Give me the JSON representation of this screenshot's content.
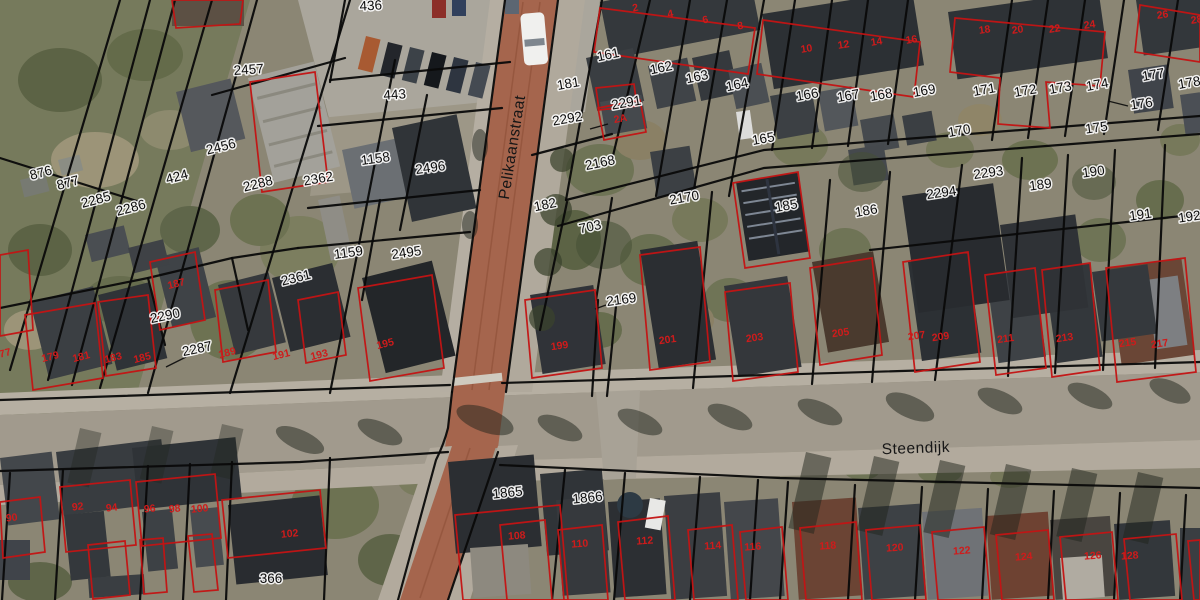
{
  "map": {
    "type": "cadastral-aerial",
    "street_labels": [
      {
        "text": "Pelikaanstraat",
        "x": 517,
        "y": 148,
        "rot": -81
      },
      {
        "text": "Steendijk",
        "x": 916,
        "y": 453,
        "rot": -2
      }
    ],
    "parcel_labels": [
      {
        "text": "436",
        "x": 371,
        "y": 10,
        "rot": -3
      },
      {
        "text": "443",
        "x": 395,
        "y": 99,
        "rot": -4
      },
      {
        "text": "2457",
        "x": 249,
        "y": 74,
        "rot": -4
      },
      {
        "text": "2456",
        "x": 222,
        "y": 151,
        "rot": -14
      },
      {
        "text": "2288",
        "x": 259,
        "y": 188,
        "rot": -14
      },
      {
        "text": "876",
        "x": 42,
        "y": 177,
        "rot": -15
      },
      {
        "text": "877",
        "x": 69,
        "y": 187,
        "rot": -15
      },
      {
        "text": "2285",
        "x": 97,
        "y": 204,
        "rot": -15
      },
      {
        "text": "2286",
        "x": 132,
        "y": 212,
        "rot": -15
      },
      {
        "text": "424",
        "x": 178,
        "y": 181,
        "rot": -15
      },
      {
        "text": "2362",
        "x": 319,
        "y": 183,
        "rot": -10
      },
      {
        "text": "1158",
        "x": 376,
        "y": 163,
        "rot": -8
      },
      {
        "text": "2496",
        "x": 431,
        "y": 172,
        "rot": -8
      },
      {
        "text": "1159",
        "x": 349,
        "y": 257,
        "rot": -8
      },
      {
        "text": "2495",
        "x": 407,
        "y": 257,
        "rot": -8
      },
      {
        "text": "2361",
        "x": 297,
        "y": 282,
        "rot": -14
      },
      {
        "text": "2290",
        "x": 166,
        "y": 320,
        "rot": -12
      },
      {
        "text": "2287",
        "x": 198,
        "y": 353,
        "rot": -12
      },
      {
        "text": "181",
        "x": 569,
        "y": 88,
        "rot": -10
      },
      {
        "text": "2292",
        "x": 568,
        "y": 123,
        "rot": -10
      },
      {
        "text": "2291",
        "x": 627,
        "y": 107,
        "rot": -10
      },
      {
        "text": "161",
        "x": 609,
        "y": 59,
        "rot": -12
      },
      {
        "text": "162",
        "x": 662,
        "y": 72,
        "rot": -12
      },
      {
        "text": "163",
        "x": 698,
        "y": 81,
        "rot": -12
      },
      {
        "text": "164",
        "x": 738,
        "y": 89,
        "rot": -12
      },
      {
        "text": "165",
        "x": 764,
        "y": 143,
        "rot": -10
      },
      {
        "text": "166",
        "x": 808,
        "y": 99,
        "rot": -10
      },
      {
        "text": "167",
        "x": 849,
        "y": 100,
        "rot": -10
      },
      {
        "text": "168",
        "x": 882,
        "y": 99,
        "rot": -10
      },
      {
        "text": "169",
        "x": 925,
        "y": 95,
        "rot": -10
      },
      {
        "text": "170",
        "x": 960,
        "y": 135,
        "rot": -10
      },
      {
        "text": "171",
        "x": 985,
        "y": 94,
        "rot": -10
      },
      {
        "text": "172",
        "x": 1026,
        "y": 95,
        "rot": -10
      },
      {
        "text": "173",
        "x": 1061,
        "y": 92,
        "rot": -10
      },
      {
        "text": "174",
        "x": 1098,
        "y": 89,
        "rot": -10
      },
      {
        "text": "175",
        "x": 1097,
        "y": 132,
        "rot": -8
      },
      {
        "text": "176",
        "x": 1142,
        "y": 108,
        "rot": -8
      },
      {
        "text": "177",
        "x": 1154,
        "y": 79,
        "rot": -10
      },
      {
        "text": "178",
        "x": 1190,
        "y": 87,
        "rot": -10
      },
      {
        "text": "2168",
        "x": 601,
        "y": 167,
        "rot": -12
      },
      {
        "text": "182",
        "x": 546,
        "y": 209,
        "rot": -12
      },
      {
        "text": "703",
        "x": 591,
        "y": 231,
        "rot": -12
      },
      {
        "text": "2170",
        "x": 685,
        "y": 202,
        "rot": -10
      },
      {
        "text": "2169",
        "x": 622,
        "y": 304,
        "rot": -8
      },
      {
        "text": "185",
        "x": 787,
        "y": 210,
        "rot": -10
      },
      {
        "text": "186",
        "x": 867,
        "y": 215,
        "rot": -10
      },
      {
        "text": "2293",
        "x": 989,
        "y": 177,
        "rot": -8
      },
      {
        "text": "2294",
        "x": 942,
        "y": 197,
        "rot": -8
      },
      {
        "text": "189",
        "x": 1041,
        "y": 189,
        "rot": -8
      },
      {
        "text": "190",
        "x": 1094,
        "y": 176,
        "rot": -8
      },
      {
        "text": "191",
        "x": 1141,
        "y": 219,
        "rot": -8
      },
      {
        "text": "192",
        "x": 1190,
        "y": 221,
        "rot": -8
      },
      {
        "text": "1865",
        "x": 508,
        "y": 497,
        "rot": -6
      },
      {
        "text": "1866",
        "x": 588,
        "y": 502,
        "rot": -6
      },
      {
        "text": "366",
        "x": 271,
        "y": 583,
        "rot": 0
      }
    ],
    "house_numbers": [
      {
        "text": "2",
        "x": 636,
        "y": 11,
        "rot": -12
      },
      {
        "text": "4",
        "x": 671,
        "y": 17,
        "rot": -12
      },
      {
        "text": "6",
        "x": 706,
        "y": 23,
        "rot": -12
      },
      {
        "text": "8",
        "x": 741,
        "y": 29,
        "rot": -12
      },
      {
        "text": "10",
        "x": 807,
        "y": 52,
        "rot": -9
      },
      {
        "text": "12",
        "x": 844,
        "y": 48,
        "rot": -9
      },
      {
        "text": "14",
        "x": 877,
        "y": 45,
        "rot": -9
      },
      {
        "text": "16",
        "x": 912,
        "y": 43,
        "rot": -9
      },
      {
        "text": "18",
        "x": 985,
        "y": 33,
        "rot": -8
      },
      {
        "text": "20",
        "x": 1018,
        "y": 33,
        "rot": -8
      },
      {
        "text": "22",
        "x": 1055,
        "y": 32,
        "rot": -8
      },
      {
        "text": "24",
        "x": 1090,
        "y": 28,
        "rot": -8
      },
      {
        "text": "26",
        "x": 1163,
        "y": 18,
        "rot": -8
      },
      {
        "text": "28",
        "x": 1197,
        "y": 23,
        "rot": -8
      },
      {
        "text": "2A",
        "x": 621,
        "y": 122,
        "rot": -10
      },
      {
        "text": "177",
        "x": 3,
        "y": 357,
        "rot": -14
      },
      {
        "text": "179",
        "x": 51,
        "y": 360,
        "rot": -14
      },
      {
        "text": "181",
        "x": 82,
        "y": 360,
        "rot": -14
      },
      {
        "text": "183",
        "x": 114,
        "y": 361,
        "rot": -14
      },
      {
        "text": "185",
        "x": 143,
        "y": 361,
        "rot": -14
      },
      {
        "text": "187",
        "x": 177,
        "y": 287,
        "rot": -14
      },
      {
        "text": "189",
        "x": 228,
        "y": 356,
        "rot": -14
      },
      {
        "text": "191",
        "x": 282,
        "y": 358,
        "rot": -14
      },
      {
        "text": "193",
        "x": 320,
        "y": 358,
        "rot": -14
      },
      {
        "text": "195",
        "x": 386,
        "y": 347,
        "rot": -14
      },
      {
        "text": "199",
        "x": 560,
        "y": 349,
        "rot": -8
      },
      {
        "text": "201",
        "x": 668,
        "y": 343,
        "rot": -8
      },
      {
        "text": "203",
        "x": 755,
        "y": 341,
        "rot": -8
      },
      {
        "text": "205",
        "x": 841,
        "y": 336,
        "rot": -8
      },
      {
        "text": "207",
        "x": 917,
        "y": 339,
        "rot": -8
      },
      {
        "text": "209",
        "x": 941,
        "y": 340,
        "rot": -8
      },
      {
        "text": "211",
        "x": 1006,
        "y": 342,
        "rot": -8
      },
      {
        "text": "213",
        "x": 1065,
        "y": 341,
        "rot": -8
      },
      {
        "text": "215",
        "x": 1128,
        "y": 346,
        "rot": -8
      },
      {
        "text": "217",
        "x": 1160,
        "y": 347,
        "rot": -8
      },
      {
        "text": "90",
        "x": 12,
        "y": 521,
        "rot": -6
      },
      {
        "text": "92",
        "x": 78,
        "y": 510,
        "rot": -6
      },
      {
        "text": "94",
        "x": 112,
        "y": 511,
        "rot": -6
      },
      {
        "text": "96",
        "x": 150,
        "y": 512,
        "rot": -6
      },
      {
        "text": "98",
        "x": 175,
        "y": 512,
        "rot": -6
      },
      {
        "text": "100",
        "x": 200,
        "y": 512,
        "rot": -6
      },
      {
        "text": "102",
        "x": 290,
        "y": 537,
        "rot": -6
      },
      {
        "text": "108",
        "x": 517,
        "y": 539,
        "rot": -4
      },
      {
        "text": "110",
        "x": 580,
        "y": 547,
        "rot": -4
      },
      {
        "text": "112",
        "x": 645,
        "y": 544,
        "rot": -4
      },
      {
        "text": "114",
        "x": 713,
        "y": 549,
        "rot": -4
      },
      {
        "text": "116",
        "x": 753,
        "y": 550,
        "rot": -4
      },
      {
        "text": "118",
        "x": 828,
        "y": 549,
        "rot": -4
      },
      {
        "text": "120",
        "x": 895,
        "y": 551,
        "rot": -4
      },
      {
        "text": "122",
        "x": 962,
        "y": 554,
        "rot": -4
      },
      {
        "text": "124",
        "x": 1024,
        "y": 560,
        "rot": -4
      },
      {
        "text": "126",
        "x": 1093,
        "y": 559,
        "rot": -4
      },
      {
        "text": "128",
        "x": 1130,
        "y": 559,
        "rot": -4
      }
    ],
    "colors": {
      "parcel_line": "#0a0a0a",
      "building_outline": "#c41414",
      "house_number": "#cf1b1b",
      "label_text": "#0d0d0d",
      "label_halo": "#ffffff",
      "road_brick": "#a5654d",
      "road_asphalt": "#a19a8d"
    }
  }
}
